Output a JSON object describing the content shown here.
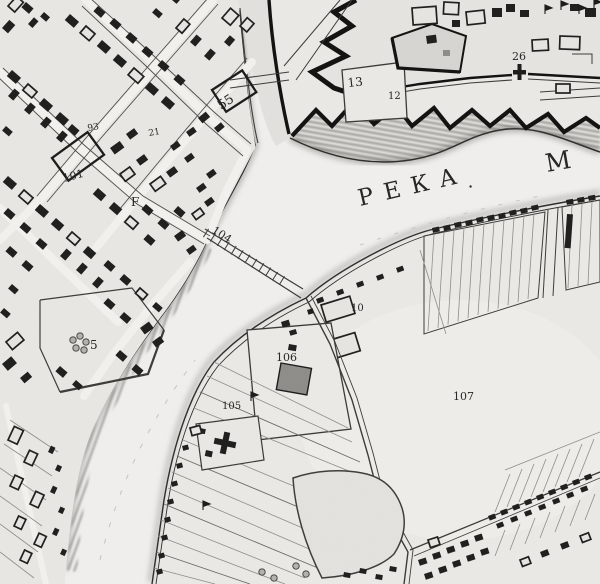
{
  "map": {
    "kind": "historical-town-plan-scan",
    "river": {
      "name_visible": "РЕКА",
      "name_continuation": "М",
      "separator_dot": "."
    },
    "colors": {
      "paper": "#ebeae6",
      "ink": "#1c1c1a",
      "water": "#f1f0ee",
      "shade": "#b7b6b2",
      "blockfill": "#e9e8e4"
    },
    "labels": [
      {
        "text": "РЕКА",
        "x": 360,
        "y": 206,
        "rot": -13,
        "size": 23,
        "spacing": 11
      },
      {
        "text": ".",
        "x": 468,
        "y": 188,
        "rot": -13,
        "size": 18
      },
      {
        "text": "М",
        "x": 547,
        "y": 172,
        "rot": -10,
        "size": 25
      },
      {
        "text": "104",
        "x": 211,
        "y": 232,
        "rot": 33,
        "size": 11
      },
      {
        "text": "55",
        "x": 221,
        "y": 110,
        "rot": -33,
        "size": 13
      },
      {
        "text": "101",
        "x": 64,
        "y": 182,
        "rot": -15,
        "size": 11
      },
      {
        "text": "F",
        "x": 131,
        "y": 206,
        "rot": 0,
        "size": 12
      },
      {
        "text": "93",
        "x": 88,
        "y": 131,
        "rot": -10,
        "size": 9
      },
      {
        "text": "21",
        "x": 149,
        "y": 136,
        "rot": -10,
        "size": 9
      },
      {
        "text": "5",
        "x": 90,
        "y": 349,
        "rot": 0,
        "size": 12
      },
      {
        "text": "13",
        "x": 348,
        "y": 87,
        "rot": -6,
        "size": 12
      },
      {
        "text": "12",
        "x": 388,
        "y": 99,
        "rot": 0,
        "size": 10
      },
      {
        "text": "26",
        "x": 512,
        "y": 60,
        "rot": 0,
        "size": 11
      },
      {
        "text": "10",
        "x": 351,
        "y": 311,
        "rot": 0,
        "size": 10
      },
      {
        "text": "106",
        "x": 276,
        "y": 361,
        "rot": 0,
        "size": 11
      },
      {
        "text": "105",
        "x": 222,
        "y": 409,
        "rot": 0,
        "size": 10
      },
      {
        "text": "107",
        "x": 453,
        "y": 400,
        "rot": 0,
        "size": 11
      }
    ],
    "markers": [
      {
        "type": "flag",
        "x": 545,
        "y": 14
      },
      {
        "type": "flag",
        "x": 561,
        "y": 10
      },
      {
        "type": "flag",
        "x": 579,
        "y": 14
      },
      {
        "type": "flag",
        "x": 594,
        "y": 8
      },
      {
        "type": "flag",
        "x": 251,
        "y": 401
      },
      {
        "type": "flag",
        "x": 203,
        "y": 510
      },
      {
        "type": "tree",
        "x": 73,
        "y": 340
      },
      {
        "type": "tree",
        "x": 80,
        "y": 336
      },
      {
        "type": "tree",
        "x": 86,
        "y": 342
      },
      {
        "type": "tree",
        "x": 76,
        "y": 348
      },
      {
        "type": "tree",
        "x": 84,
        "y": 350
      },
      {
        "type": "tree",
        "x": 262,
        "y": 572
      },
      {
        "type": "tree",
        "x": 274,
        "y": 578
      },
      {
        "type": "tree",
        "x": 296,
        "y": 566
      },
      {
        "type": "tree",
        "x": 306,
        "y": 574
      },
      {
        "type": "gate",
        "x": 519,
        "y": 70
      }
    ]
  }
}
